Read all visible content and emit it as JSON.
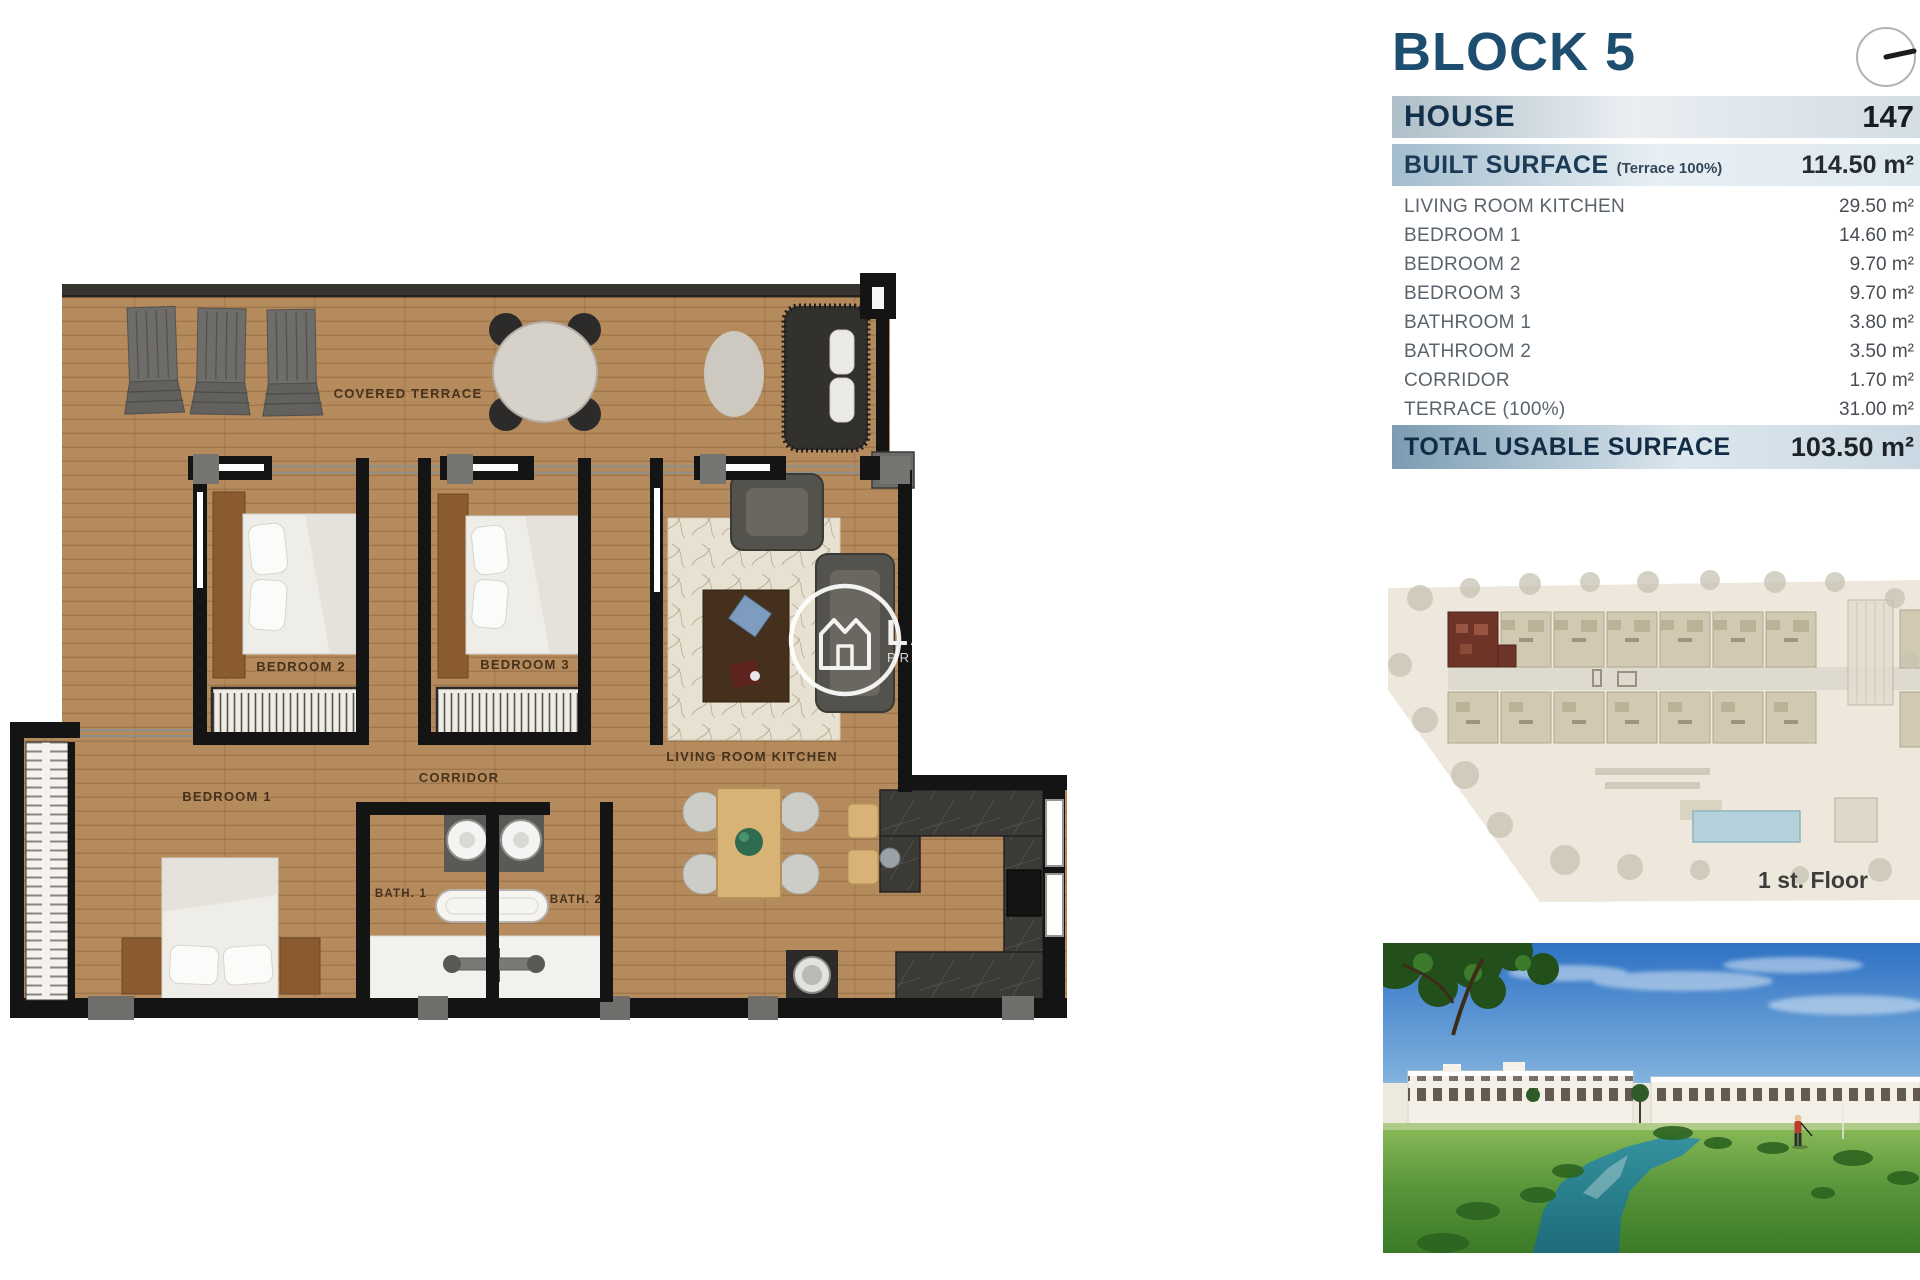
{
  "panel": {
    "block_title": "BLOCK 5",
    "house_label": "HOUSE",
    "house_number": "147",
    "built_surface_label": "BUILT SURFACE",
    "built_surface_note": "(Terrace 100%)",
    "built_surface_value": "114.50 m²",
    "rows": [
      {
        "label": "LIVING ROOM KITCHEN",
        "value": "29.50 m²"
      },
      {
        "label": "BEDROOM 1",
        "value": "14.60 m²"
      },
      {
        "label": "BEDROOM 2",
        "value": "9.70 m²"
      },
      {
        "label": "BEDROOM 3",
        "value": "9.70 m²"
      },
      {
        "label": "BATHROOM 1",
        "value": "3.80 m²"
      },
      {
        "label": "BATHROOM 2",
        "value": "3.50 m²"
      },
      {
        "label": "CORRIDOR",
        "value": "1.70 m²"
      },
      {
        "label": "TERRACE (100%)",
        "value": "31.00 m²"
      }
    ],
    "total_label": "TOTAL USABLE SURFACE",
    "total_value": "103.50 m²"
  },
  "floor_plan": {
    "labels": {
      "covered_terrace": "COVERED TERRACE",
      "bedroom1": "BEDROOM 1",
      "bedroom2": "BEDROOM 2",
      "bedroom3": "BEDROOM 3",
      "corridor": "CORRIDOR",
      "living": "LIVING ROOM KITCHEN",
      "bath1": "BATH. 1",
      "bath2": "BATH. 2"
    }
  },
  "watermark": {
    "initials": "LA",
    "subtext": "PR"
  },
  "site_plan": {
    "caption": "1 st. Floor"
  },
  "colors": {
    "title_navy": "#1d4e70",
    "bar_steel_blue": "#7b9cb2",
    "wood": "#b58a5c",
    "wall_black": "#141414",
    "highlight_unit": "#6d3427",
    "pool_blue": "#b5d2dc",
    "sky_blue": "#2e72c4",
    "grass_green": "#57963a",
    "stream_teal": "#1d6b7a"
  }
}
